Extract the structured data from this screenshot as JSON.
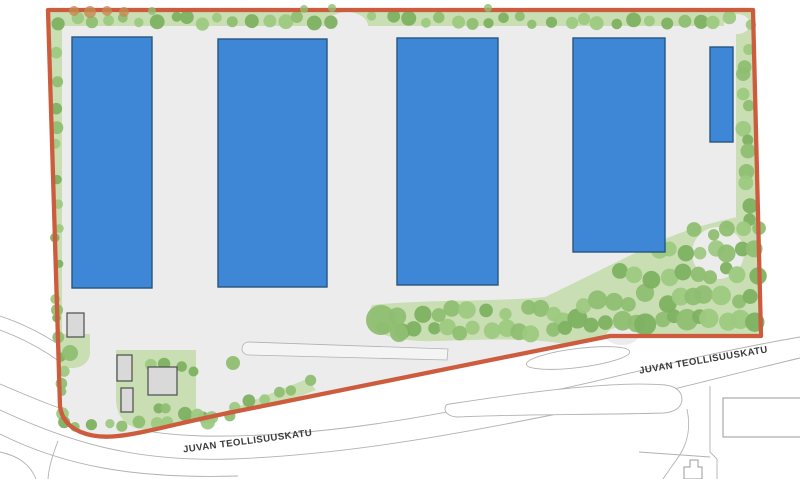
{
  "map": {
    "kind": "industrial-site-plan",
    "street_labels": {
      "bottom": "JUVAN TEOLLISUUSKATU",
      "right": "JUVAN TEOLLISUUSKATU"
    },
    "counts": {
      "blue_buildings": 5,
      "small_gray_buildings": 4,
      "street_label_instances": 2
    },
    "colors": {
      "background": "#ffffff",
      "boundary": "#cd5c3f",
      "site_ground": "#ececec",
      "grass": "#c9deb2",
      "tree": "#8fbe72",
      "tree_dark": "#7eb161",
      "tree_light": "#9dc981",
      "tree_autumn": "#c68a50",
      "building_fill": "#3d87d6",
      "building_outline": "#29567f",
      "outbuilding_fill": "#d9d9d9",
      "outbuilding_outline": "#4d4d4d",
      "road_line": "#b1b1b1",
      "neighbor_fill": "#ffffff",
      "inner_road_fill": "#f4f4f4",
      "label_text": "#3a3a3a"
    }
  }
}
